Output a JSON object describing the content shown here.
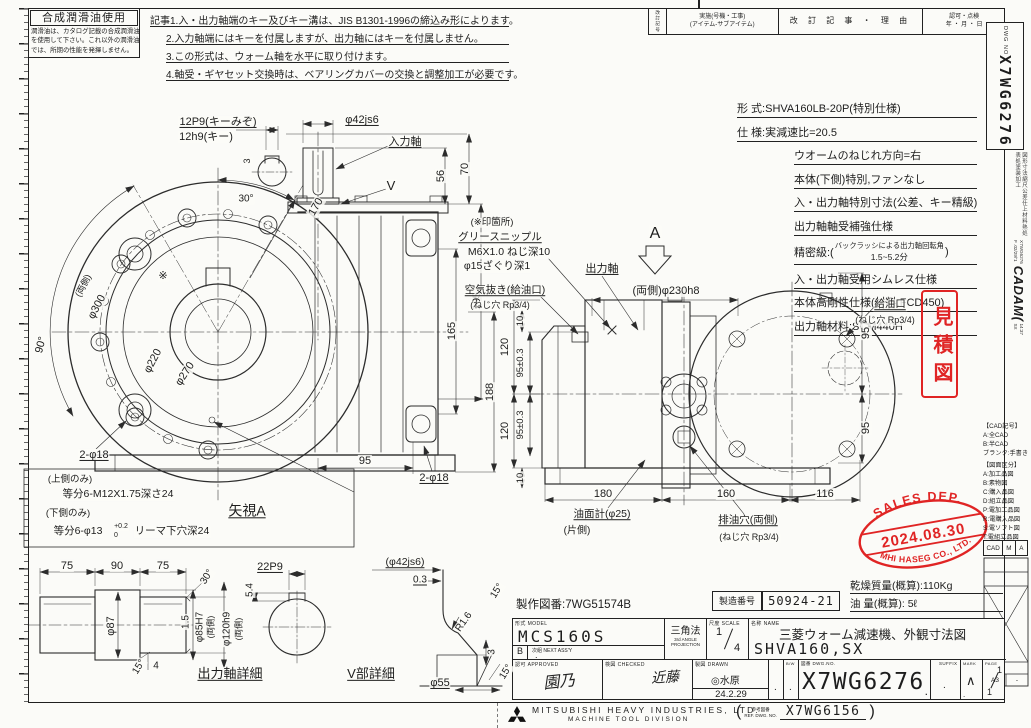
{
  "lubricant": {
    "title": "合成潤滑油使用",
    "lines": [
      "潤滑油は、カタログ記載の合成潤滑油",
      "を使用して下さい。これ以外の潤滑油",
      "では、所期の性能を発揮しません。"
    ]
  },
  "notes": {
    "lines": [
      "記事1.入・出力軸端のキー及びキー溝は、JIS B1301-1996の締込み形によります。",
      "2.入力軸端にはキーを付属しますが、出力軸にはキーを付属しません。",
      "3.この形式は、ウォーム軸を水平に取り付けます。",
      "4.軸受・ギヤセット交換時は、ベアリングカバーの交換と調整加工が必要です。"
    ]
  },
  "revision": {
    "side_label": "改訂記号",
    "exec_line1": "実施(号機・工事)",
    "exec_line2": "(アイテム-サブアイテム)",
    "history": "改 訂 記 事 ・ 理 由",
    "approve": "認可・点検",
    "date": "年 ・ 月 ・ 日"
  },
  "dwg_box": {
    "label": "DWG NO",
    "number": "X7WG6276"
  },
  "margin": {
    "kanji_column": "図形寸法縮尺公差仕上材料熱処表処塗装加工",
    "cadam_no": "X7WG6276",
    "cadam_logo": "CADAM(",
    "cadam_date": "F .02/29/'1",
    "cadam_time": "14:37",
    "cadam_sx": "SX"
  },
  "legend": {
    "cad_title": "【CAD記号】",
    "cad_items": [
      "A:全CAD",
      "B:半CAD",
      "ブランク:手書き"
    ],
    "class_title": "【図面区分】",
    "class_items": [
      "A:加工品図",
      "B:素物図",
      "C:購入品図",
      "D:組立品図",
      "P:電加工品図",
      "R:電購入品図",
      "S:電ソフト図",
      "T:電組立品図"
    ],
    "cad_cells": [
      "CAD",
      "M",
      "A"
    ],
    "paper": "A3",
    "scale_dash": "-"
  },
  "specs": {
    "lines": [
      "形 式:SHVA160LB-20P(特別仕様)",
      "仕 様:実減速比=20.5",
      "ウオームのねじれ方向=右",
      "本体(下側)特別,ファンなし",
      "入・出力軸特別寸法(公差、キー精級)",
      "出力軸軸受補強仕様",
      "入・出力軸受用シムレス仕様",
      "本体高剛性仕様(材料:FCD450)",
      "出力軸材料:SCM440H"
    ],
    "precision_prefix": "精密級:(",
    "precision_line1": "バックラッシによる出力軸回転角",
    "precision_line2": "1.5~5.2分",
    "precision_suffix": ")"
  },
  "stamps": {
    "estimate": "見積図",
    "sales_top": "SALES DEP.",
    "sales_date": "2024.08.30",
    "sales_bottom": "MHI HASEG CO., LTD.",
    "red": "#e02424"
  },
  "titleblock": {
    "seisaku": "製作図番:7WG51574B",
    "seizo_label": "製造番号",
    "seizo_value": "50924-21",
    "mass": "乾燥質量(概算):110Kg",
    "oil": "油 量(概算): 5ℓ",
    "model_label": "形式 MODEL",
    "model": "MCS160S",
    "b_mark": "B",
    "next_label": "次組 NEXT ASS'Y",
    "next_value": ".",
    "projection_jp": "三角法",
    "projection_en1": "3rd ANGLE",
    "projection_en2": "PROJECTION",
    "scale_label": "尺度 SCALE",
    "scale_num": "1",
    "scale_den": "4",
    "name_label": "名称 NAME",
    "name1": "三菱ウォーム減速機、外観寸法図",
    "name2": "SHVA160,SX",
    "approved_label": "認可 APPROVED",
    "approved_sig": "園乃",
    "checked_label": "検図 CHECKED",
    "checked_sig": "近藤",
    "drawn_label": "製図 DRAWN",
    "drawn_sig": "◎水原",
    "drawn_date": "24.2.29",
    "dot1": ".",
    "dot2": ".",
    "bw_label": "B/W",
    "dwg_label": "図番 DWG.NO.",
    "dwg_no": "X7WG6276",
    "dwg_dot": ".",
    "suffix_label": "SUFFIX",
    "suffix_value": ".",
    "mark_label": "MARK",
    "mark_value": "∧",
    "mark_dot": ".",
    "page_label": "PAGE",
    "page_top": "1",
    "page_bottom": "1",
    "company": "MITSUBISHI HEAVY INDUSTRIES, LTD.",
    "division": "MACHINE TOOL DIVISION",
    "ref_open": "(",
    "ref_label": "参考図番",
    "ref_label2": "REF. DWG. NO.",
    "ref_value": "X7WG6156",
    "ref_close": ")"
  },
  "drawing": {
    "annotations": [
      {
        "t": "12P9(キーみぞ)",
        "x": 218,
        "y": 122,
        "u": 1
      },
      {
        "t": "12h9(キー)",
        "x": 206,
        "y": 137
      },
      {
        "t": "φ42js6",
        "x": 362,
        "y": 120,
        "u": 1
      },
      {
        "t": "入力軸",
        "x": 405,
        "y": 142,
        "u": 1
      },
      {
        "t": "V",
        "x": 391,
        "y": 186,
        "s": 13
      },
      {
        "t": "3",
        "x": 248,
        "y": 161,
        "r": -90,
        "s": 9
      },
      {
        "t": "30°",
        "x": 246,
        "y": 199,
        "s": 10
      },
      {
        "t": "170",
        "x": 316,
        "y": 207,
        "r": -60,
        "s": 11
      },
      {
        "t": "56",
        "x": 441,
        "y": 176,
        "r": -90,
        "s": 11
      },
      {
        "t": "70",
        "x": 465,
        "y": 169,
        "r": -90,
        "s": 11
      },
      {
        "t": "195",
        "x": 477,
        "y": 301,
        "r": -90,
        "s": 11
      },
      {
        "t": "165",
        "x": 452,
        "y": 331,
        "r": -90,
        "s": 11
      },
      {
        "t": "188",
        "x": 490,
        "y": 392,
        "r": -90,
        "s": 11
      },
      {
        "t": "(両側)",
        "x": 84,
        "y": 286,
        "r": -62,
        "s": 9
      },
      {
        "t": "φ300",
        "x": 97,
        "y": 307,
        "r": -62,
        "s": 11
      },
      {
        "t": "90°",
        "x": 41,
        "y": 345,
        "r": -75,
        "s": 11
      },
      {
        "t": "φ270",
        "x": 185,
        "y": 374,
        "r": -57,
        "s": 11
      },
      {
        "t": "φ220",
        "x": 153,
        "y": 361,
        "r": -62,
        "s": 11
      },
      {
        "t": "※",
        "x": 163,
        "y": 276,
        "s": 11
      },
      {
        "t": "2-φ18",
        "x": 94,
        "y": 455,
        "u": 1
      },
      {
        "t": "(上側のみ)",
        "x": 70,
        "y": 480,
        "s": 9.5
      },
      {
        "t": "等分6-M12X1.75深さ24",
        "x": 118,
        "y": 495,
        "s": 10.5
      },
      {
        "t": "(下側のみ)",
        "x": 68,
        "y": 514,
        "s": 9.5
      },
      {
        "t": "等分6-φ13",
        "x": 78,
        "y": 532,
        "s": 10.5
      },
      {
        "t": "+0.2",
        "x": 121,
        "y": 527,
        "s": 7
      },
      {
        "t": "0",
        "x": 116,
        "y": 536,
        "s": 7
      },
      {
        "t": "リーマ下穴深24",
        "x": 172,
        "y": 532,
        "s": 10.5
      },
      {
        "t": "矢視A",
        "x": 247,
        "y": 511,
        "s": 14,
        "u": 1
      },
      {
        "t": "95",
        "x": 365,
        "y": 461,
        "s": 11
      },
      {
        "t": "2-φ18",
        "x": 434,
        "y": 478,
        "u": 1
      },
      {
        "t": "(※印箇所)",
        "x": 492,
        "y": 223,
        "s": 9.5
      },
      {
        "t": "グリースニップル",
        "x": 500,
        "y": 238,
        "u": 1,
        "s": 10.5
      },
      {
        "t": "M6X1.0 ねじ深10",
        "x": 509,
        "y": 253,
        "s": 10.5
      },
      {
        "t": "φ15ざぐり深1",
        "x": 497,
        "y": 267,
        "s": 10.5
      },
      {
        "t": "空気抜き(給油口)",
        "x": 505,
        "y": 291,
        "u": 1,
        "s": 10.5
      },
      {
        "t": "(ねじ穴 Rp3/4)",
        "x": 500,
        "y": 306,
        "s": 9
      },
      {
        "t": "出力軸",
        "x": 602,
        "y": 269,
        "u": 1
      },
      {
        "t": "A",
        "x": 655,
        "y": 234,
        "s": 16
      },
      {
        "t": "(両側)φ230h8",
        "x": 666,
        "y": 291,
        "s": 11
      },
      {
        "t": "10",
        "x": 521,
        "y": 321,
        "r": -90,
        "s": 9.5
      },
      {
        "t": "120",
        "x": 505,
        "y": 347,
        "r": -90,
        "s": 11
      },
      {
        "t": "95±0.3",
        "x": 521,
        "y": 363,
        "r": -90,
        "s": 9.5
      },
      {
        "t": "120",
        "x": 505,
        "y": 431,
        "r": -90,
        "s": 11
      },
      {
        "t": "95±0.3",
        "x": 521,
        "y": 425,
        "r": -90,
        "s": 9.5
      },
      {
        "t": "10",
        "x": 521,
        "y": 478,
        "r": -90,
        "s": 9.5
      },
      {
        "t": "180",
        "x": 603,
        "y": 494,
        "s": 11
      },
      {
        "t": "160",
        "x": 726,
        "y": 494,
        "s": 11
      },
      {
        "t": "116",
        "x": 825,
        "y": 494,
        "s": 11
      },
      {
        "t": "95",
        "x": 866,
        "y": 333,
        "r": -90,
        "s": 11
      },
      {
        "t": "95",
        "x": 866,
        "y": 428,
        "r": -90,
        "s": 11
      },
      {
        "t": "油面計(φ25)",
        "x": 602,
        "y": 515,
        "u": 1,
        "s": 10.5
      },
      {
        "t": "(片側)",
        "x": 577,
        "y": 531,
        "s": 10
      },
      {
        "t": "排油穴(両側)",
        "x": 748,
        "y": 521,
        "u": 1,
        "s": 10.5
      },
      {
        "t": "(ねじ穴 Rp3/4)",
        "x": 749,
        "y": 538,
        "s": 9
      },
      {
        "t": "給油口",
        "x": 890,
        "y": 305,
        "u": 1,
        "s": 10.5
      },
      {
        "t": "(ねじ穴 Rp3/4)",
        "x": 885,
        "y": 321,
        "s": 9
      },
      {
        "t": "75",
        "x": 67,
        "y": 566,
        "s": 11
      },
      {
        "t": "90",
        "x": 117,
        "y": 566,
        "s": 11
      },
      {
        "t": "75",
        "x": 163,
        "y": 566,
        "s": 11
      },
      {
        "t": "30°",
        "x": 207,
        "y": 577,
        "r": -58,
        "s": 10
      },
      {
        "t": "22P9",
        "x": 270,
        "y": 567,
        "u": 1
      },
      {
        "t": "5.4",
        "x": 250,
        "y": 590,
        "r": -90,
        "s": 10
      },
      {
        "t": "φ87",
        "x": 111,
        "y": 626,
        "r": -90,
        "s": 11
      },
      {
        "t": "1.5",
        "x": 186,
        "y": 622,
        "r": -90,
        "s": 10
      },
      {
        "t": "φ85H7",
        "x": 200,
        "y": 627,
        "r": -90,
        "s": 10
      },
      {
        "t": "(両側)",
        "x": 211,
        "y": 627,
        "r": -90,
        "s": 8.5
      },
      {
        "t": "φ120h9",
        "x": 227,
        "y": 629,
        "r": -90,
        "s": 10
      },
      {
        "t": "(両側)",
        "x": 239,
        "y": 629,
        "r": -90,
        "s": 8.5
      },
      {
        "t": "15°",
        "x": 139,
        "y": 667,
        "r": -58,
        "s": 10
      },
      {
        "t": "4",
        "x": 156,
        "y": 666,
        "s": 10
      },
      {
        "t": "出力軸詳細",
        "x": 230,
        "y": 674,
        "s": 13,
        "u": 1
      },
      {
        "t": "(φ42js6)",
        "x": 405,
        "y": 563,
        "u": 1,
        "s": 10.5
      },
      {
        "t": "0.3",
        "x": 420,
        "y": 580,
        "u": 1,
        "s": 10
      },
      {
        "t": "15°",
        "x": 497,
        "y": 591,
        "r": -58,
        "s": 10
      },
      {
        "t": "R1.6",
        "x": 464,
        "y": 622,
        "r": -55,
        "s": 10
      },
      {
        "t": "3",
        "x": 492,
        "y": 652,
        "r": -90,
        "s": 10
      },
      {
        "t": "15°",
        "x": 506,
        "y": 672,
        "r": -58,
        "s": 10
      },
      {
        "t": "φ55",
        "x": 440,
        "y": 683,
        "u": 1,
        "s": 11
      },
      {
        "t": "V部詳細",
        "x": 371,
        "y": 674,
        "s": 13,
        "u": 1
      }
    ]
  }
}
